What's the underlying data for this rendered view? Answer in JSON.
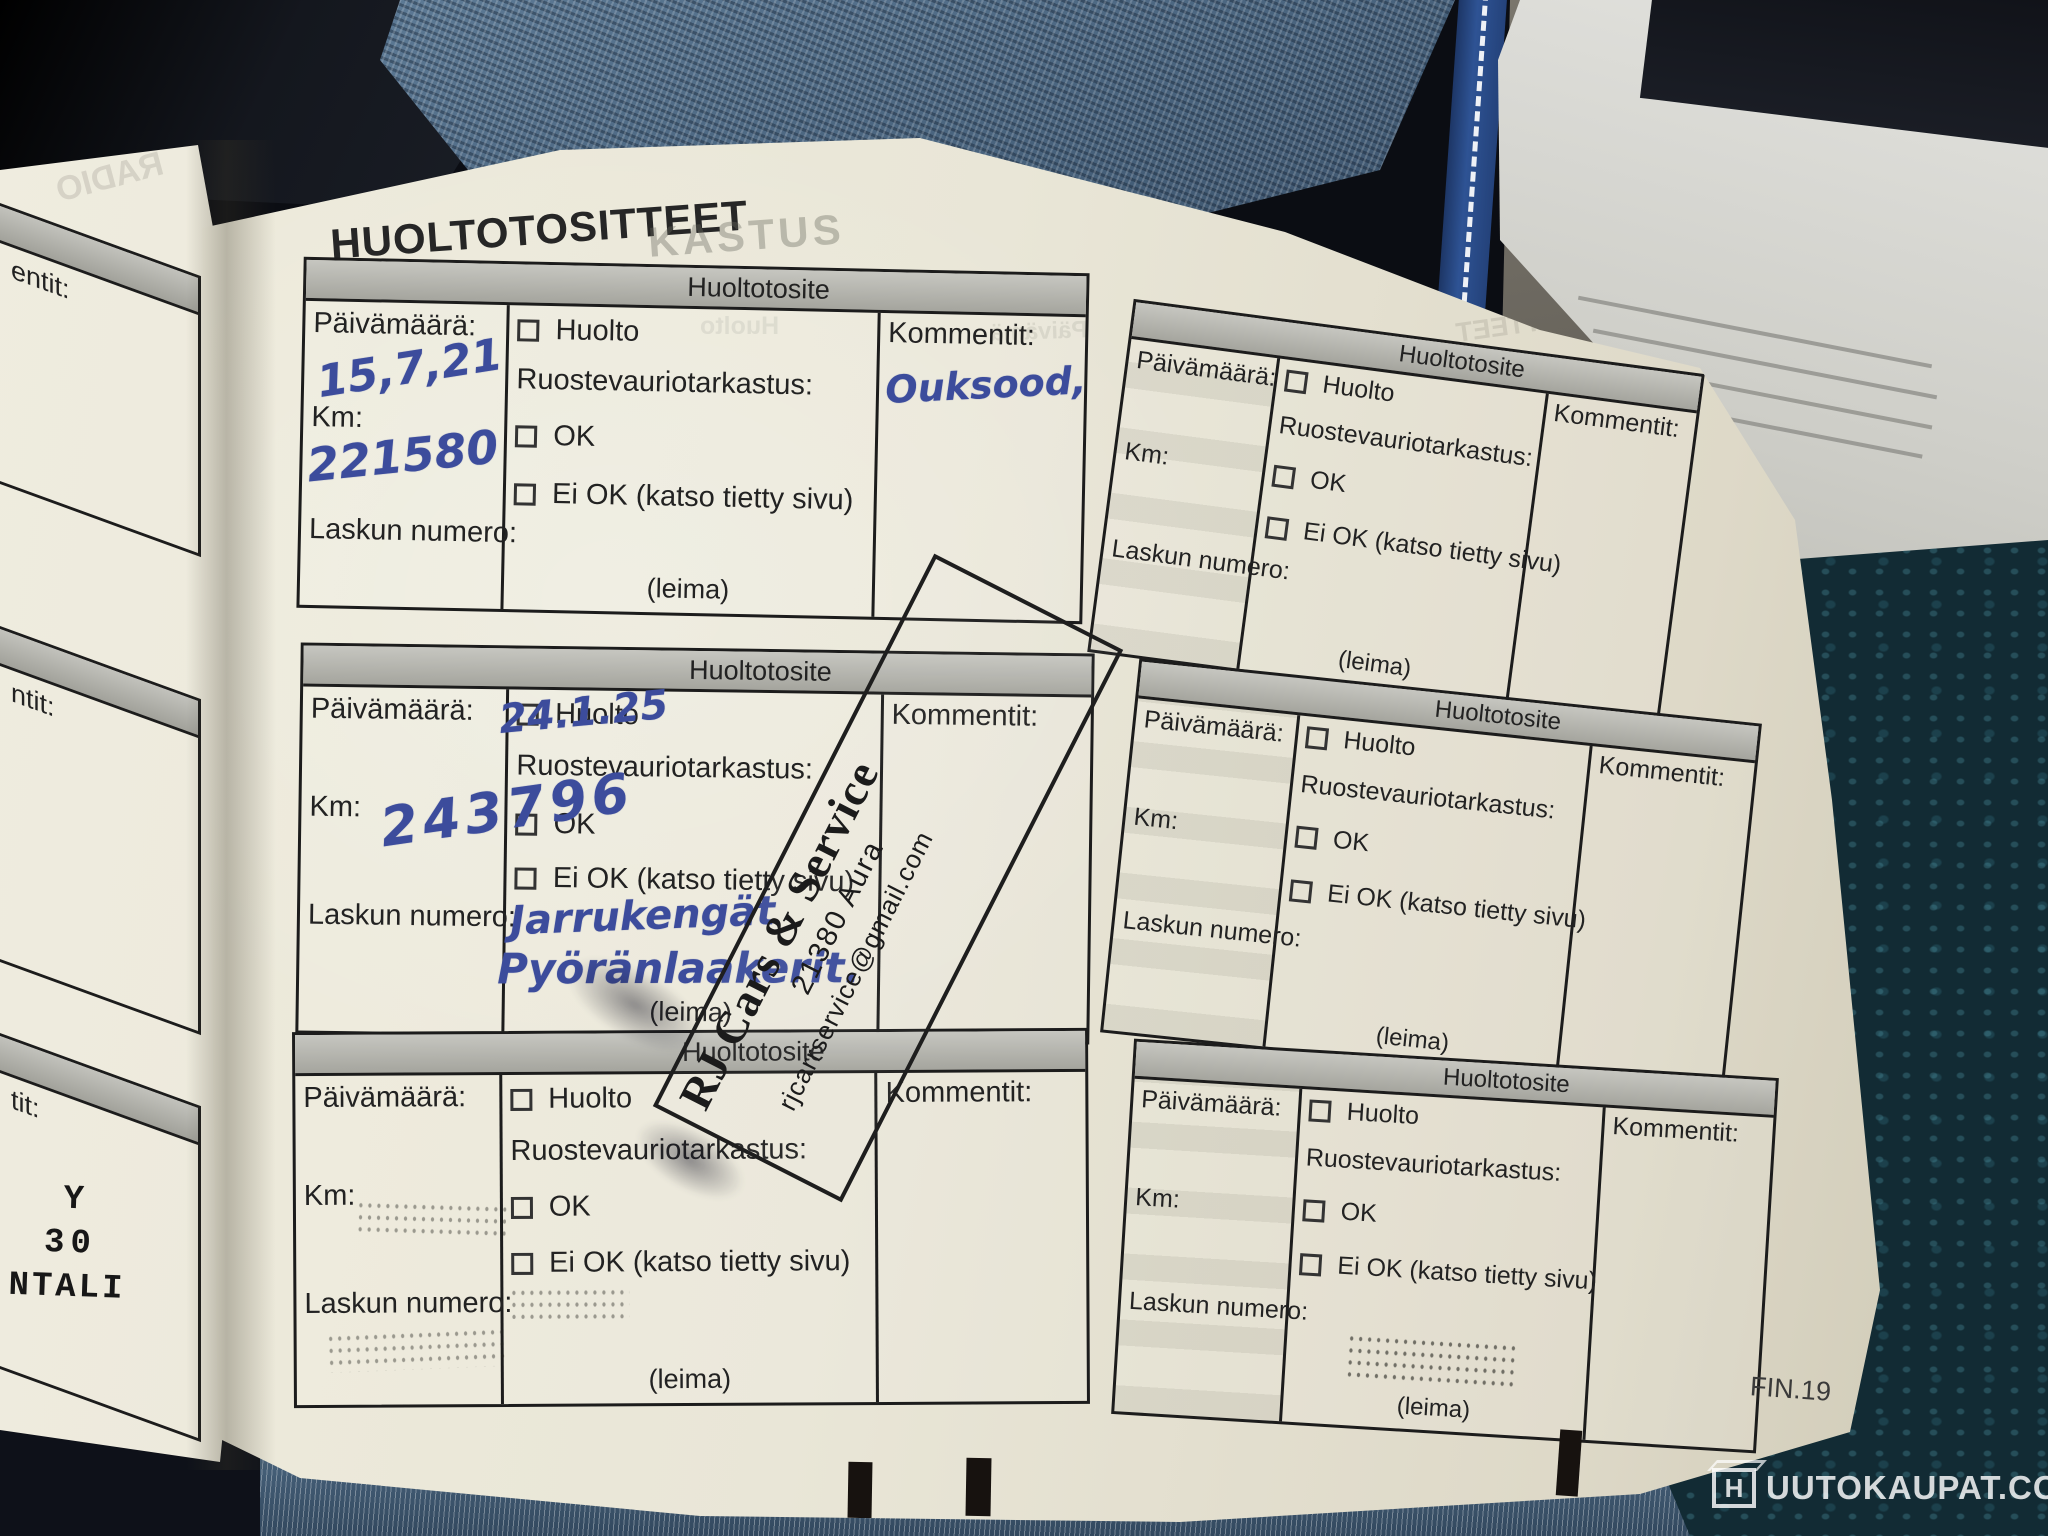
{
  "page": {
    "title": "HUOLTOTOSITTEET",
    "page_code": "FIN.19"
  },
  "form_labels": {
    "box_header": "Huoltotosite",
    "date": "Päivämäärä:",
    "km": "Km:",
    "invoice": "Laskun numero:",
    "service": "Huolto",
    "rust_check": "Ruostevauriotarkastus:",
    "ok": "OK",
    "not_ok": "Ei OK (katso tietty sivu)",
    "comments": "Kommentit:",
    "stamp_placeholder": "(leima)"
  },
  "entries": {
    "box1": {
      "date": "15,7,21",
      "km": "221580",
      "comment": "Ouksood,"
    },
    "box3": {
      "date": "24.1.25",
      "km": "243796",
      "note_line1": "Jarrukengät",
      "note_line2": "Pyöränlaakerit."
    }
  },
  "stamps": {
    "rj": {
      "name": "RJ Cars & Service",
      "city": "21380 Aura",
      "email": "rjcarrservice@gmail.com"
    },
    "left_page_partial": {
      "line1": "Y",
      "line2": "30",
      "line3": "NTALI"
    }
  },
  "ghosts": {
    "title_fragment": "KASTUS",
    "mirrored_title": "HUOLTOTOSITTEET",
    "radio": "RADIO",
    "date_fragment": "Päivämä",
    "service_fragment": "Huolto"
  },
  "left_page": {
    "fragment_1": "entit:",
    "fragment_2": "ntit:",
    "fragment_3": "tit:"
  },
  "watermark": {
    "logo_letter": "H",
    "text": "UUTOKAUPAT.COM"
  },
  "colors": {
    "paper": "#e9e6d7",
    "ink_blue": "#3c4c9c",
    "stamp_black": "#1d1d1d",
    "denim": "#56728c",
    "seat_teal": "#122b34"
  }
}
